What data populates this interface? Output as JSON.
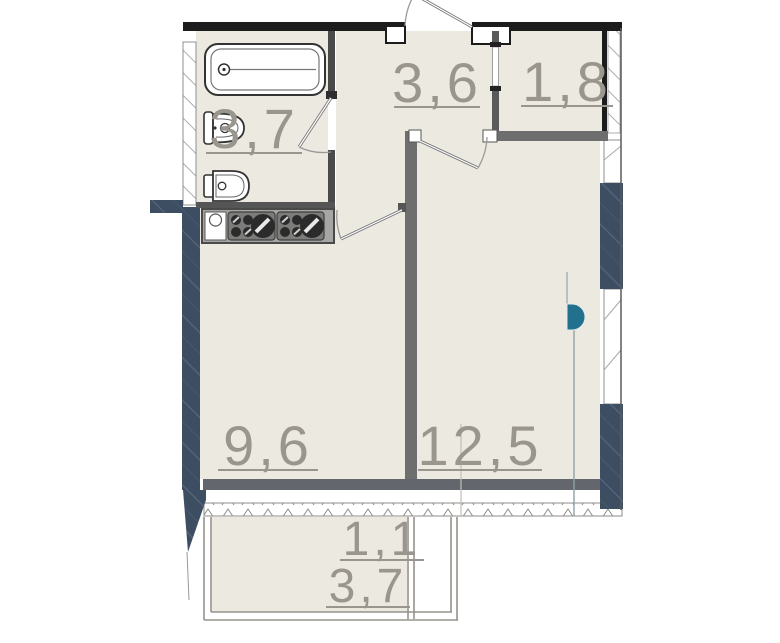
{
  "plan": {
    "type": "apartment-floor-plan",
    "area_labels": {
      "bathroom": "3,7",
      "hallway": "3,6",
      "storage": "1,8",
      "kitchen": "9,6",
      "room": "12,5",
      "balcony_small": "1,1",
      "balcony": "3,7"
    },
    "fixtures": [
      "bathtub-icon",
      "washbasin-icon",
      "toilet-icon",
      "kitchen-sink-icon",
      "stove-burners-icon",
      "window-glazing-band",
      "balcony-railing",
      "entry-door-swing",
      "interior-door-swing",
      "riser-marker"
    ],
    "colors": {
      "floor_fill": "#ebe9e0",
      "exterior_wall_dark": "#3e4e62",
      "interior_wall_gray": "#6e6e6e",
      "outline_black": "#1c1c1c",
      "accent_teal": "#20708e",
      "label_text": "#9a968e"
    }
  }
}
